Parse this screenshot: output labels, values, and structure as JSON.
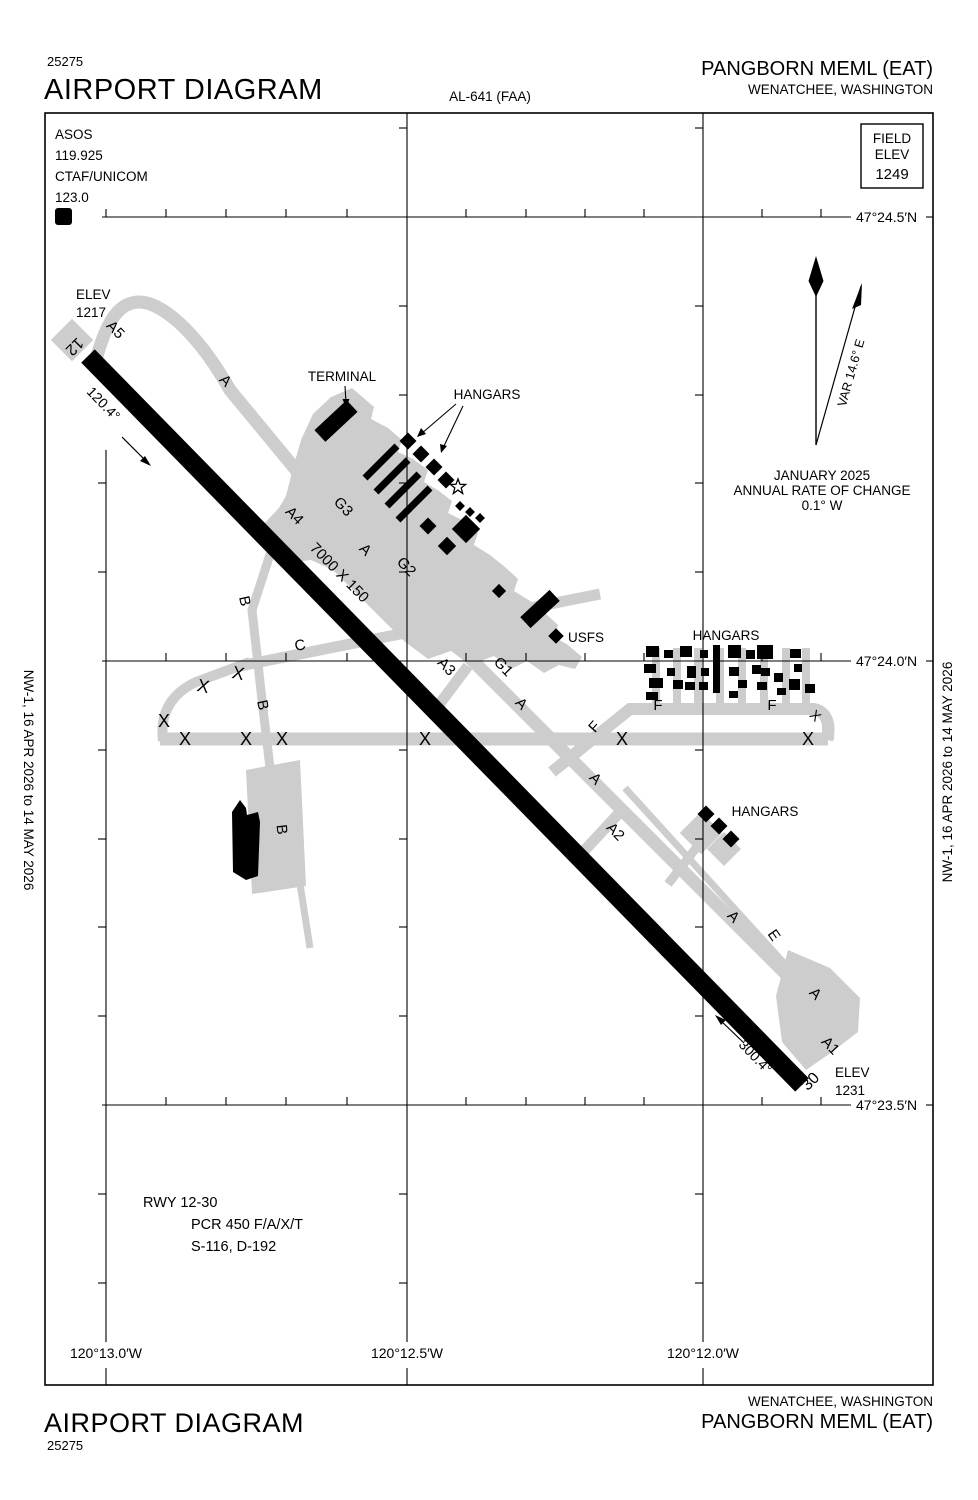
{
  "page": {
    "sheet_number": "25275",
    "title": "AIRPORT DIAGRAM",
    "chart_ref": "AL-641 (FAA)",
    "airport_name": "PANGBORN MEML ",
    "airport_id": "(EAT)",
    "city": "WENATCHEE, WASHINGTON",
    "margin_note": "NW-1,  16 APR 2026  to  14 MAY 2026"
  },
  "comm": {
    "asos_label": "ASOS",
    "asos_freq": "119.925",
    "ctaf_label": "CTAF/UNICOM",
    "ctaf_freq": "123.0",
    "diagram_symbol": "D"
  },
  "field_elevation": {
    "label_line1": "FIELD",
    "label_line2": "ELEV",
    "value": "1249"
  },
  "grid": {
    "lat_labels": [
      "47°24.5′N",
      "47°24.0′N",
      "47°23.5′N"
    ],
    "lon_labels": [
      "120°13.0′W",
      "120°12.5′W",
      "120°12.0′W"
    ]
  },
  "compass": {
    "variation": "VAR 14.6° E",
    "date": "JANUARY 2025",
    "rate_line1": "ANNUAL RATE OF CHANGE",
    "rate_line2": "0.1° W"
  },
  "runway": {
    "end12_id": "12",
    "end30_id": "30",
    "end12_heading": "120.4°",
    "end30_heading": "300.4°",
    "dimensions": "7000 X 150",
    "elev_label": "ELEV",
    "end12_elev": "1217",
    "end30_elev": "1231",
    "info_line1": "RWY 12-30",
    "info_line2": "PCR 450 F/A/X/T",
    "info_line3": "S-116, D-192"
  },
  "taxiways": {
    "a": "A",
    "a1": "A1",
    "a2": "A2",
    "a3": "A3",
    "a4": "A4",
    "a5": "A5",
    "b": "B",
    "c": "C",
    "e": "E",
    "f": "F",
    "g1": "G1",
    "g2": "G2",
    "g3": "G3",
    "closed_marker": "X"
  },
  "features": {
    "terminal": "TERMINAL",
    "hangars": "HANGARS",
    "usfs": "USFS"
  }
}
